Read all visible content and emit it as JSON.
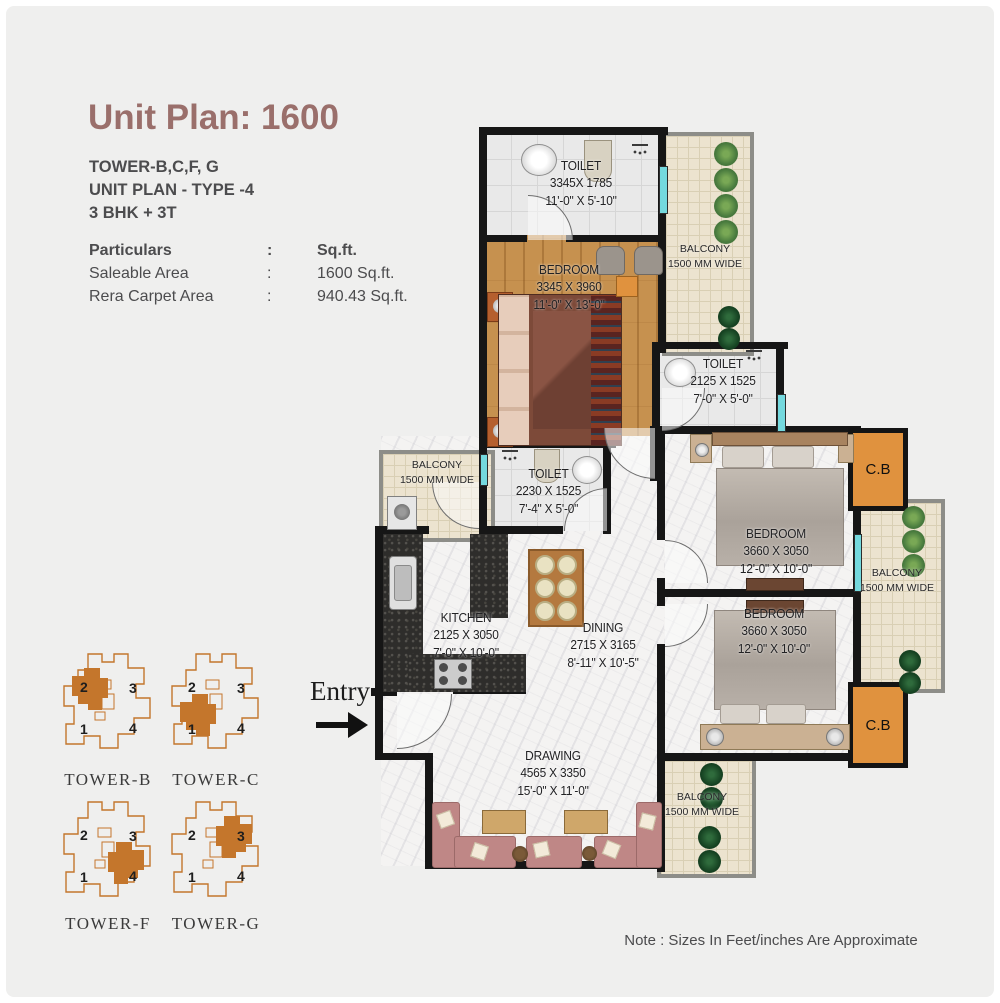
{
  "header": {
    "title": "Unit Plan: 1600",
    "tower_line": "TOWER-B,C,F, G",
    "type_line": "UNIT PLAN - TYPE -4",
    "bhk_line": "3 BHK + 3T"
  },
  "particulars": {
    "head": {
      "label": "Particulars",
      "colon": ":",
      "value": "Sq.ft."
    },
    "rows": [
      {
        "label": "Saleable Area",
        "colon": ":",
        "value": "1600 Sq.ft."
      },
      {
        "label": "Rera Carpet  Area",
        "colon": ":",
        "value": "940.43 Sq.ft."
      }
    ]
  },
  "plan": {
    "entry_label": "Entry",
    "rooms": {
      "toilet_top": {
        "name": "TOILET",
        "dim_mm": "3345X 1785",
        "dim_ft": "11'-0\" X 5'-10\""
      },
      "bedroom_1": {
        "name": "BEDROOM",
        "dim_mm": "3345 X 3960",
        "dim_ft": "11'-0\" X 13'-0\""
      },
      "balcony_top": {
        "name": "BALCONY",
        "dim_mm": "1500 MM WIDE"
      },
      "toilet_mid": {
        "name": "TOILET",
        "dim_mm": "2125 X 1525",
        "dim_ft": "7'-0\" X 5'-0\""
      },
      "bedroom_2": {
        "name": "BEDROOM",
        "dim_mm": "3660 X 3050",
        "dim_ft": "12'-0\" X 10'-0\""
      },
      "balcony_right": {
        "name": "BALCONY",
        "dim_mm": "1500 MM WIDE"
      },
      "bedroom_3": {
        "name": "BEDROOM",
        "dim_mm": "3660 X 3050",
        "dim_ft": "12'-0\" X 10'-0\""
      },
      "cb_top": {
        "label": "C.B"
      },
      "cb_bottom": {
        "label": "C.B"
      },
      "balcony_kitchen": {
        "name": "BALCONY",
        "dim_mm": "1500 MM WIDE"
      },
      "toilet_common": {
        "name": "TOILET",
        "dim_mm": "2230 X 1525",
        "dim_ft": "7'-4\" X 5'-0\""
      },
      "kitchen": {
        "name": "KITCHEN",
        "dim_mm": "2125 X 3050",
        "dim_ft": "7'-0\" X 10'-0\""
      },
      "dining": {
        "name": "DINING",
        "dim_mm": "2715 X 3165",
        "dim_ft": "8'-11\" X 10'-5\""
      },
      "drawing": {
        "name": "DRAWING",
        "dim_mm": "4565 X 3350",
        "dim_ft": "15'-0\" X 11'-0\""
      },
      "balcony_bottom": {
        "name": "BALCONY",
        "dim_mm": "1500 MM WIDE"
      }
    }
  },
  "towers": [
    {
      "name": "TOWER-B",
      "unit1": "1",
      "unit2": "2",
      "unit3": "3",
      "unit4": "4",
      "highlighted_unit": "2"
    },
    {
      "name": "TOWER-C",
      "unit1": "1",
      "unit2": "2",
      "unit3": "3",
      "unit4": "4",
      "highlighted_unit": "1"
    },
    {
      "name": "TOWER-F",
      "unit1": "1",
      "unit2": "2",
      "unit3": "3",
      "unit4": "4",
      "highlighted_unit": "4"
    },
    {
      "name": "TOWER-G",
      "unit1": "1",
      "unit2": "2",
      "unit3": "3",
      "unit4": "4",
      "highlighted_unit": "3"
    }
  ],
  "note": "Note : Sizes In Feet/inches Are Approximate",
  "colors": {
    "background": "#efefee",
    "title_accent": "#9a6f6b",
    "wall": "#161616",
    "cupboard_orange": "#e0923e",
    "tower_orange": "#c4762c",
    "window_teal": "#74d9de",
    "sofa_rose": "#bf8786",
    "wood_floor": "#c6914f"
  }
}
